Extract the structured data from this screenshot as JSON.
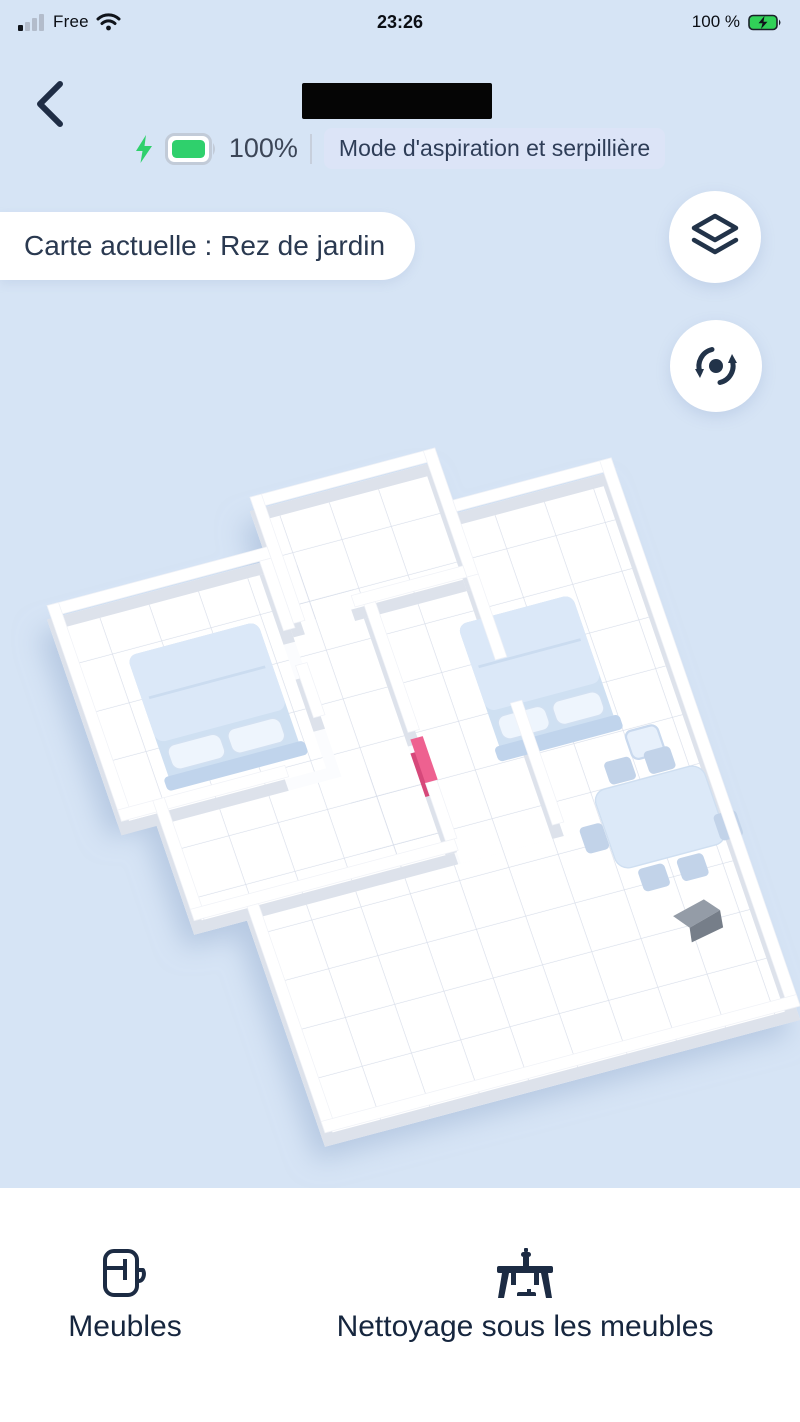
{
  "status_bar": {
    "carrier": "Free",
    "time": "23:26",
    "battery_percent": "100 %",
    "signal_icon": "cellular-signal-1-of-4",
    "wifi_icon": "wifi-full",
    "battery_icon": "battery-charging-green"
  },
  "header": {
    "back_icon": "chevron-left",
    "device_name": "",
    "device_name_redacted": true,
    "battery_percent": "100%",
    "charging_icon": "lightning-bolt-green",
    "mode_badge": "Mode d'aspiration et serpillière"
  },
  "map_bar": {
    "current_map_label": "Carte actuelle : Rez de jardin",
    "layers_button_icon": "map-layers",
    "rotate_button_icon": "rotate-3d"
  },
  "map": {
    "type": "3d-floor-plan",
    "objects": [
      "bed-left",
      "bed-right",
      "nightstand",
      "dining-table",
      "chairs",
      "virtual-wall-pink",
      "charging-dock"
    ]
  },
  "bottom_bar": {
    "items": [
      {
        "label": "Meubles",
        "icon": "furniture-cabinet"
      },
      {
        "label": "Nettoyage sous les meubles",
        "icon": "table-with-robot"
      }
    ]
  },
  "colors": {
    "background": "#d6e4f5",
    "badge_bg": "#dce4f7",
    "battery_green": "#2fd06c",
    "navy": "#1c2b43",
    "virtual_wall_pink": "#ee6190",
    "map_floor": "#ffffff"
  }
}
